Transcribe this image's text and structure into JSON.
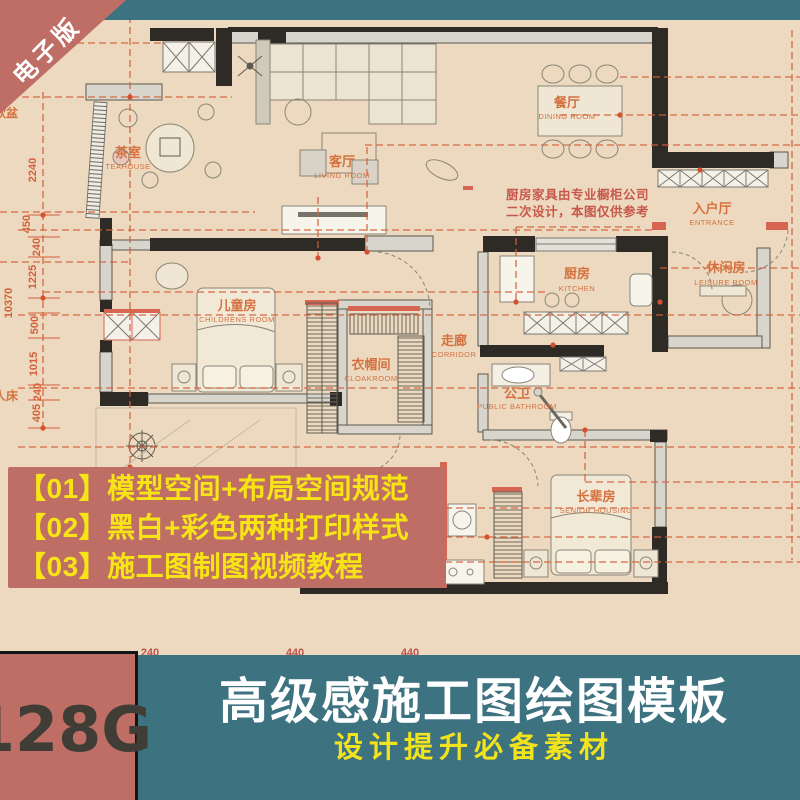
{
  "ribbon": {
    "label": "电子版"
  },
  "plan": {
    "rooms": {
      "teahouse": {
        "cn": "茶室",
        "en": "TEAHOUSE"
      },
      "living": {
        "cn": "客厅",
        "en": "LIVING ROOM"
      },
      "dining": {
        "cn": "餐厅",
        "en": "DINING ROOM"
      },
      "entrance": {
        "cn": "入户厅",
        "en": "ENTRANCE"
      },
      "kitchen": {
        "cn": "厨房",
        "en": "KITCHEN"
      },
      "leisure": {
        "cn": "休闲房",
        "en": "LEISURE ROOM"
      },
      "children": {
        "cn": "儿童房",
        "en": "CHILDRENS ROOM"
      },
      "cloak": {
        "cn": "衣帽间",
        "en": "CLOAKROOM"
      },
      "corridor": {
        "cn": "走廊",
        "en": "CORRIDOR"
      },
      "bath": {
        "cn": "公卫",
        "en": "PUBLIC BATHROOM"
      },
      "senior": {
        "cn": "长辈房",
        "en": "SENIOR HOUSING"
      }
    },
    "note": {
      "line1": "厨房家具由专业橱柜公司",
      "line2": "二次设计，本图仅供参考"
    },
    "dims_left": {
      "d1": "2240",
      "d2": "450",
      "d3": "240",
      "d4": "1225",
      "total": "10370",
      "d5": "500",
      "d6": "1015",
      "d7": "240",
      "d8": "405"
    },
    "dims_bottom": {
      "b1": "240",
      "b2": "440",
      "b3": "440"
    },
    "edge_labels": {
      "left_top": "软盆",
      "left_bottom": "人床"
    }
  },
  "promo": {
    "line1": "【01】模型空间+布局空间规范",
    "line2": "【02】黑白+彩色两种打印样式",
    "line3": "【03】施工图制图视频教程"
  },
  "footer": {
    "capacity": "128G",
    "title": "高级感施工图绘图模板",
    "subtitle": "设计提升必备素材"
  },
  "colors": {
    "teal": "#3d7280",
    "salmon": "#bf6e66",
    "yellow": "#f6e417",
    "beige": "#ecd9bf",
    "dim_orange": "#d4603a",
    "wall_dark": "#2e2b27"
  }
}
